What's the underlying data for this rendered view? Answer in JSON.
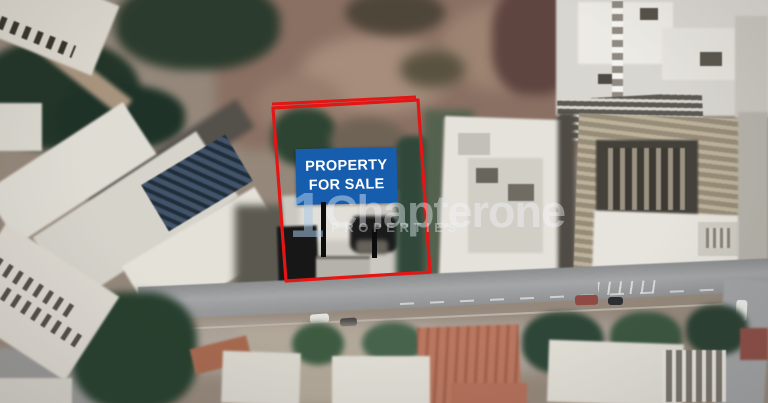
{
  "sign": {
    "line1": "PROPERTY",
    "line2": "FOR SALE",
    "bg_color": "#175dad",
    "text_color": "#ffffff"
  },
  "boundary": {
    "color": "#e31616"
  },
  "watermark": {
    "numeral": "1",
    "brand": "Chapterone",
    "tagline": "PROPERTIES",
    "numeral_color": "rgba(168,200,230,0.55)",
    "brand_color": "rgba(242,246,250,0.42)",
    "tagline_color": "rgba(240,244,248,0.40)"
  }
}
